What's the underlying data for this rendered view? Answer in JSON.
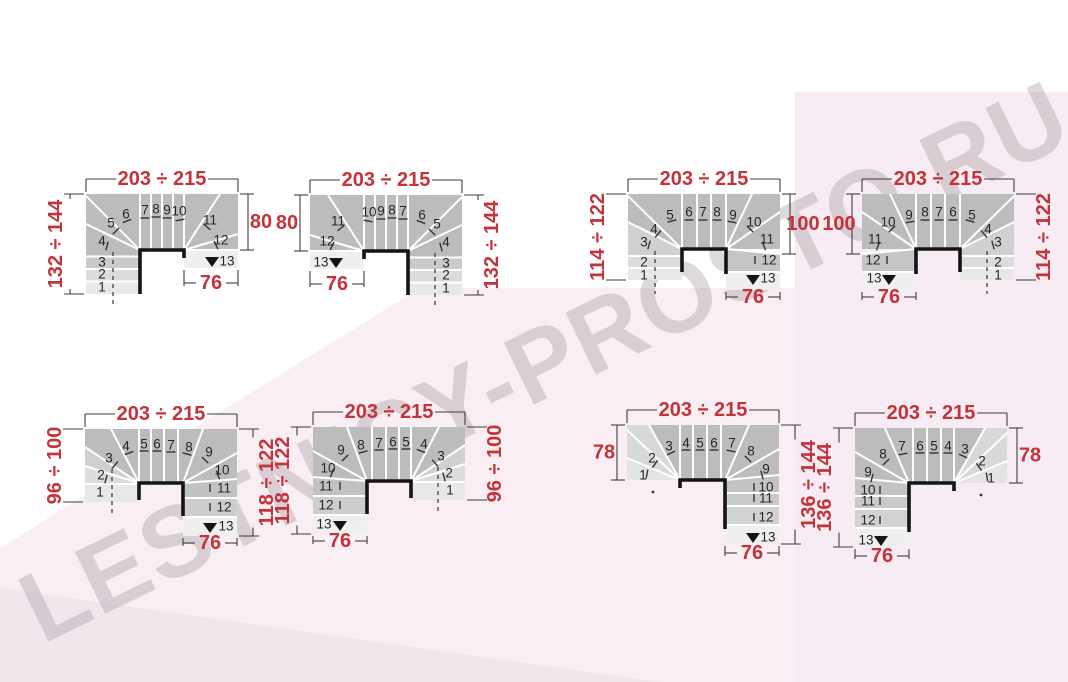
{
  "watermark": {
    "text": "LESTNICY-PROSTO.RU"
  },
  "palette": {
    "dim_text": "#c4323a",
    "dim_line": "#3d3d3d",
    "step_number": "#262626",
    "band_gray": "#bcbcbc",
    "wall_black": "#141414",
    "step_line_white": "#ffffff",
    "pink_main": "#f8eef4",
    "pink_right": "#f7ecf3",
    "pink_deep": "#f2e6ed",
    "watermark_gray": "rgba(168,155,163,0.38)"
  },
  "diagrams": [
    {
      "id": "d1",
      "variant": "A",
      "mirror": false,
      "dims": {
        "top": "203 ÷ 215",
        "left": "132 ÷ 144",
        "right": "80",
        "bottom": "76"
      },
      "numbers": [
        "1",
        "2",
        "3",
        "4",
        "5",
        "6",
        "7",
        "8",
        "9",
        "10",
        "11",
        "12",
        "13"
      ]
    },
    {
      "id": "d2",
      "variant": "A",
      "mirror": true,
      "dims": {
        "top": "203 ÷ 215",
        "left": "80",
        "right": "132 ÷ 144",
        "bottom": "76"
      },
      "numbers": [
        "1",
        "2",
        "3",
        "4",
        "5",
        "6",
        "7",
        "8",
        "9",
        "10",
        "11",
        "12",
        "13"
      ]
    },
    {
      "id": "d3",
      "variant": "B",
      "mirror": false,
      "dims": {
        "top": "203 ÷ 215",
        "left": "114 ÷ 122",
        "right": "100",
        "bottom": "76"
      },
      "numbers": [
        "1",
        "2",
        "3",
        "4",
        "5",
        "6",
        "7",
        "8",
        "9",
        "10",
        "11",
        "12",
        "13"
      ]
    },
    {
      "id": "d4",
      "variant": "B",
      "mirror": true,
      "dims": {
        "top": "203 ÷ 215",
        "left": "100",
        "right": "114 ÷ 122",
        "bottom": "76"
      },
      "numbers": [
        "1",
        "2",
        "3",
        "4",
        "5",
        "6",
        "7",
        "8",
        "9",
        "10",
        "11",
        "12",
        "13"
      ]
    },
    {
      "id": "d5",
      "variant": "C",
      "mirror": false,
      "dims": {
        "top": "203 ÷ 215",
        "left": "96 ÷ 100",
        "right": "118 ÷ 122",
        "bottom": "76"
      },
      "numbers": [
        "1",
        "2",
        "3",
        "4",
        "5",
        "6",
        "7",
        "8",
        "9",
        "10",
        "11",
        "12",
        "13"
      ]
    },
    {
      "id": "d6",
      "variant": "C",
      "mirror": true,
      "dims": {
        "top": "203 ÷ 215",
        "left": "118 ÷ 122",
        "right": "96 ÷ 100",
        "bottom": "76"
      },
      "numbers": [
        "1",
        "2",
        "3",
        "4",
        "5",
        "6",
        "7",
        "8",
        "9",
        "10",
        "11",
        "12",
        "13"
      ]
    },
    {
      "id": "d7",
      "variant": "D",
      "mirror": false,
      "dims": {
        "top": "203 ÷ 215",
        "left": "78",
        "right": "136 ÷ 144",
        "bottom": "76"
      },
      "numbers": [
        "1",
        "2",
        "3",
        "4",
        "5",
        "6",
        "7",
        "8",
        "9",
        "10",
        "11",
        "12",
        "13"
      ]
    },
    {
      "id": "d8",
      "variant": "D",
      "mirror": true,
      "dims": {
        "top": "203 ÷ 215",
        "left": "136 ÷ 144",
        "right": "78",
        "bottom": "76"
      },
      "numbers": [
        "1",
        "2",
        "3",
        "4",
        "5",
        "6",
        "7",
        "8",
        "9",
        "10",
        "11",
        "12",
        "13"
      ]
    }
  ]
}
